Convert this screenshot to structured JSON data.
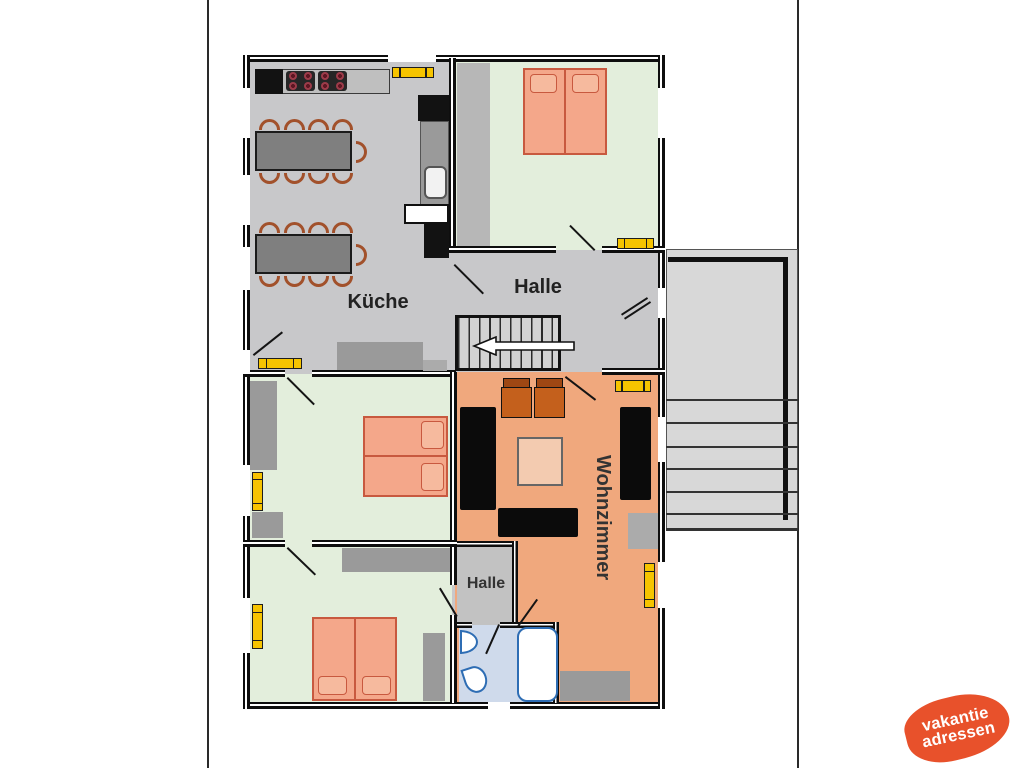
{
  "labels": {
    "kitchen": "Küche",
    "hall_main": "Halle",
    "hall_small": "Halle",
    "living_room": "Wohnzimmer"
  },
  "logo": {
    "line1": "vakantie",
    "line2": "adressen",
    "blob_color": "#e8512b",
    "text_color": "#ffffff"
  },
  "palette": {
    "floor_hall_kitchen": "#c8c8ca",
    "floor_bedroom": "#e3eedc",
    "floor_living_room": "#f0a87d",
    "floor_bathroom": "#cfdaeb",
    "floor_small_hall": "#c2c2c2",
    "wall": "#0e0e0e",
    "furniture_black": "#0b0b0b",
    "furniture_gray": "#9a9a9a",
    "table_gray": "#7f7f7f",
    "bed_fill": "#f4a78a",
    "bed_border": "#c8593f",
    "pillow_fill": "#f6ba9e",
    "window_marker_yellow": "#f6c400",
    "chair_brown": "#a2512b",
    "armchair_seat": "#c4601c",
    "armchair_back": "#9e4713",
    "coffee_table": "#f3cbb0",
    "bath_fixture_border": "#2e6db4",
    "stair_fill": "#d8d8d8",
    "burner_red": "#9c3b49"
  }
}
